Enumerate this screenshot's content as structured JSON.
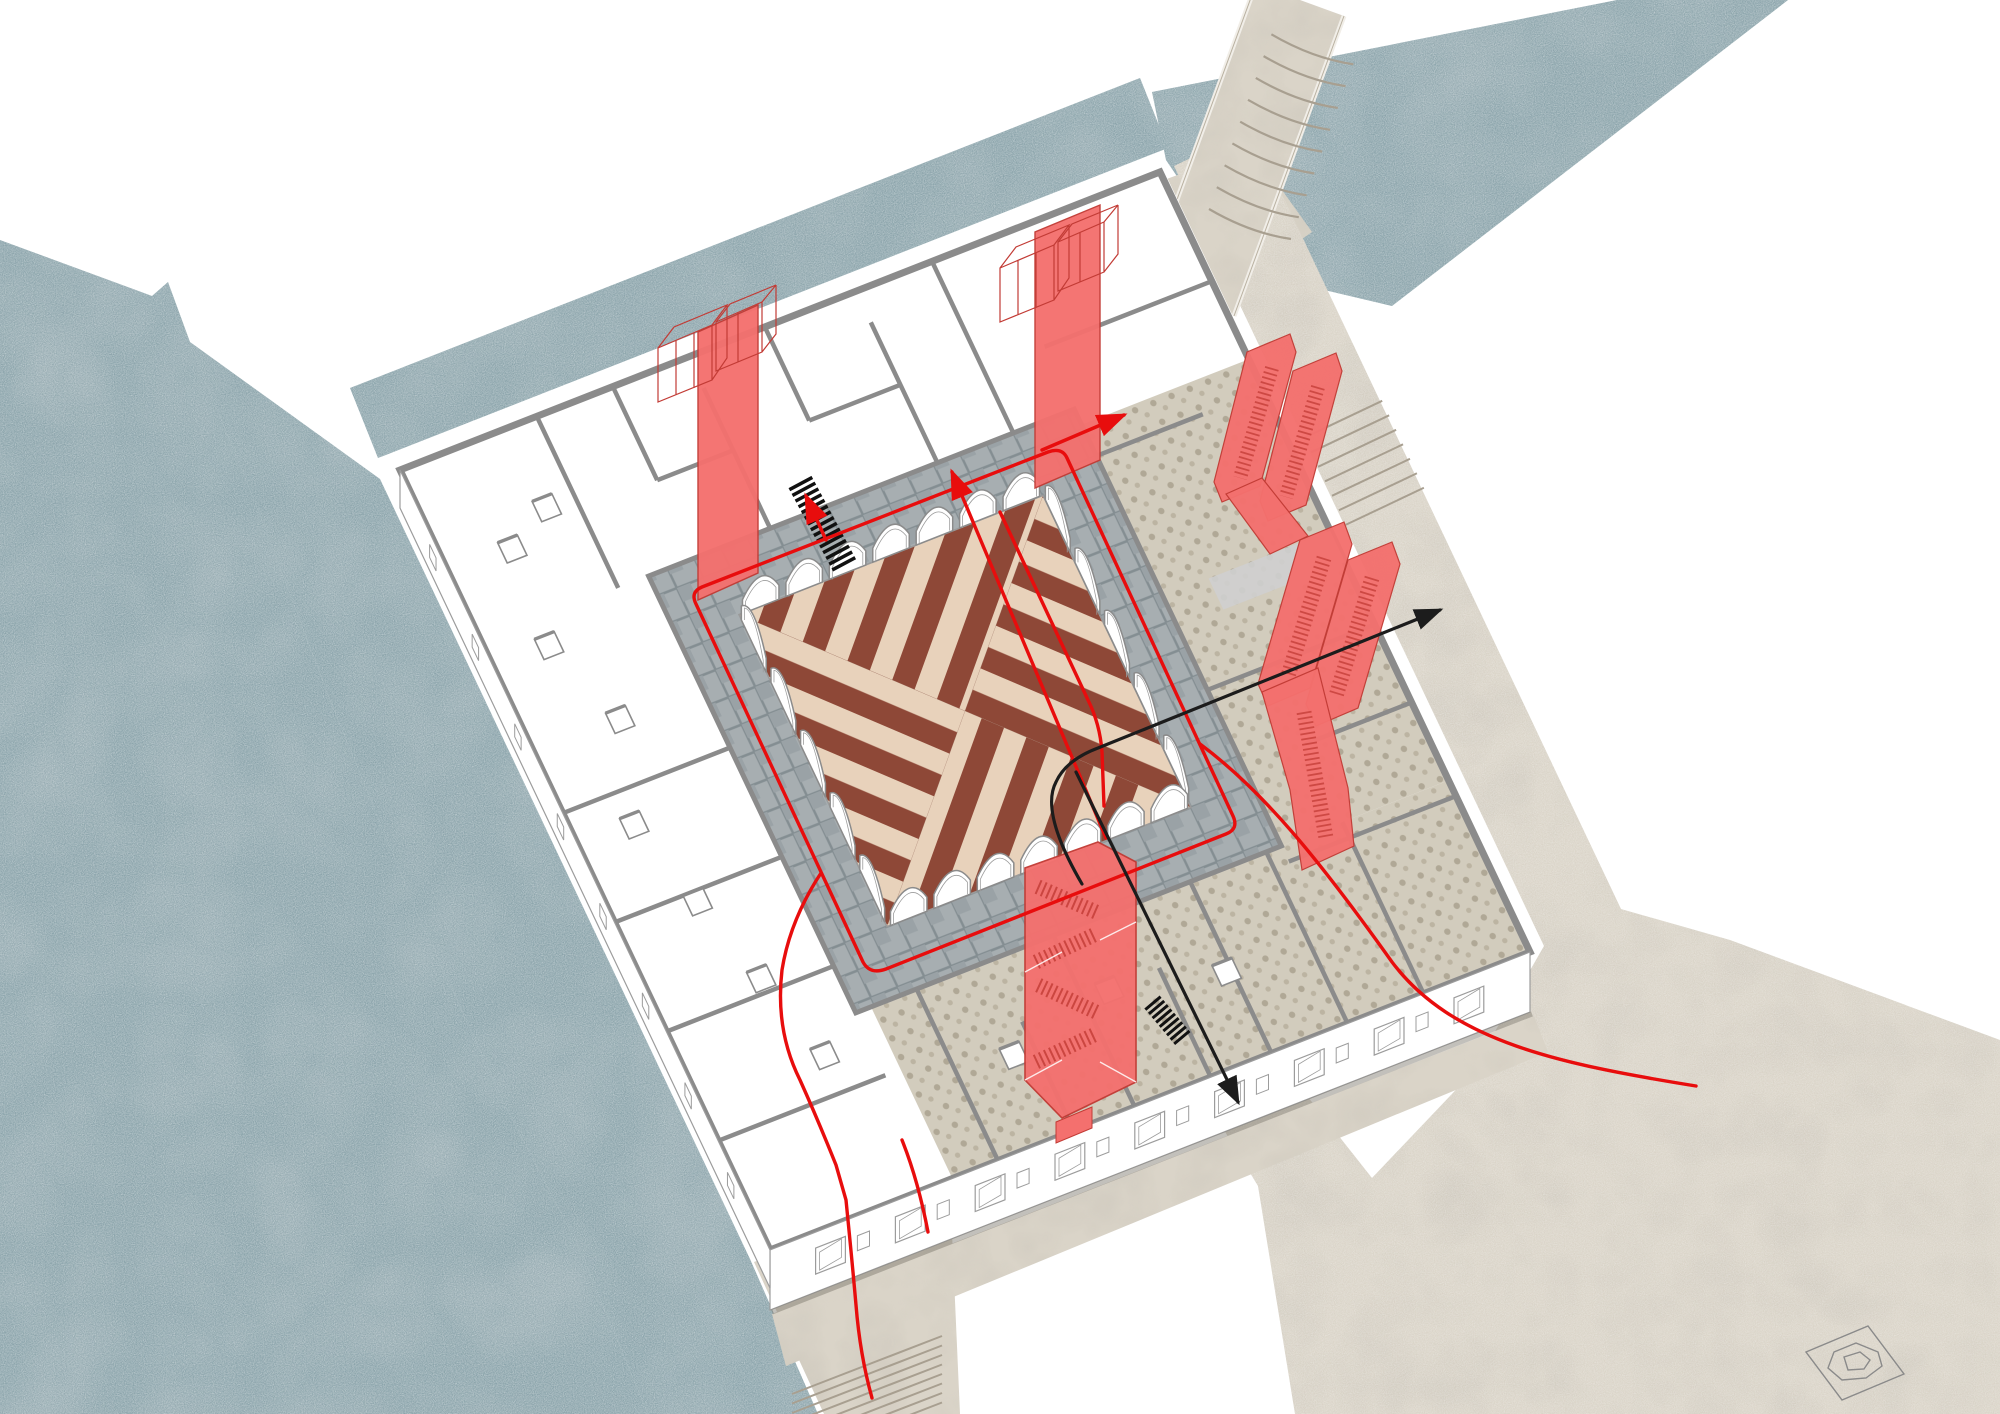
{
  "scene": {
    "type": "axonometric-architectural-circulation-diagram",
    "subject": "palazzo-floor-plan-cutaway-with-courtyard",
    "context": "canals-water-and-stone-paved-campi"
  },
  "palette": {
    "background": "#ffffff",
    "water": "#8ba4ab",
    "water_deep": "#7e99a1",
    "paving": "#dad4c8",
    "paving_shade": "#b4ab9a",
    "step_line": "#a89f90",
    "wall_gray": "#8b8b8b",
    "line_gray": "#9c9c9c",
    "thin_line": "#777777",
    "gallery_tile": "#a7aeb1",
    "gallery_joint": "#848e92",
    "pebble": "#d2ccbd",
    "pebble_dot": "#b0a896",
    "courtyard_dark": "#8e4837",
    "courtyard_light": "#e8d2bb",
    "red_fill": "#f4706e",
    "red_edge": "#c23b35",
    "path_red": "#e80d0d",
    "path_black": "#1c1c1c",
    "shadow": "#7a756a",
    "white": "#ffffff"
  },
  "building": {
    "wings": [
      "northwest",
      "northeast",
      "southeast",
      "southwest"
    ],
    "courtyard": {
      "shape": "square",
      "floor": "diagonal-striped-marble",
      "quadrants": 4
    },
    "arcade": {
      "sides": 4,
      "arches_per_side": [
        7,
        5,
        7,
        5
      ]
    },
    "galleries": "stone-tile-ambulatory",
    "facade_windows": {
      "south_front": 9,
      "west_front": 8
    }
  },
  "circulation": {
    "elevator_shafts": [
      {
        "name": "west-shaft",
        "cabins": 2
      },
      {
        "name": "north-shaft",
        "cabins": 2
      }
    ],
    "escalators": {
      "banks": 2,
      "ribbons_per_bank": 2
    },
    "stair_tower": {
      "flights": 4
    },
    "service_stairs": 2,
    "red_route_arrows": 3,
    "black_route_arrows": 2,
    "red_routes": [
      "courtyard-loop",
      "courtyard-cross",
      "southwest-exit",
      "southeast-exit",
      "northeast-escalator-link"
    ],
    "black_routes": [
      "east-exit",
      "south-exit"
    ]
  },
  "context_features": {
    "water_bodies": [
      "west-basin",
      "northwest-canal",
      "northeast-canal"
    ],
    "streets": [
      "north-step-bridge",
      "east-street-with-steps",
      "southeast-campo",
      "south-steps"
    ],
    "campo_well": true
  }
}
